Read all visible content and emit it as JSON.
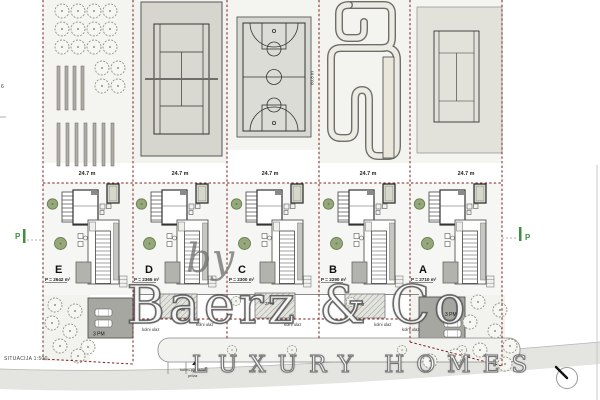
{
  "watermark": {
    "by": "by",
    "brand": "Baerz & Co",
    "tagline": "LUXURY HOMES"
  },
  "scale_label": "SITUACIJA 1:500",
  "edge_label": "6",
  "labels": {
    "kolni_ulaz": "kolni ulaz",
    "pm2": "2PM",
    "pm3": "3 PM",
    "access1": "kolno-pješački",
    "access2": "prilaz",
    "p_marker": "P",
    "court_length": "60.8 m"
  },
  "plots": [
    {
      "letter": "E",
      "area": "P = 2642 m²",
      "width_label": "24.7 m",
      "amenity": "orchard-garden"
    },
    {
      "letter": "D",
      "area": "P = 2365 m²",
      "width_label": "24.7 m",
      "amenity": "tennis-court"
    },
    {
      "letter": "C",
      "area": "P = 2300 m²",
      "width_label": "24.7 m",
      "amenity": "basketball-court"
    },
    {
      "letter": "B",
      "area": "P = 2290 m²",
      "width_label": "24.7 m",
      "amenity": "go-kart-track"
    },
    {
      "letter": "A",
      "area": "P = 2710 m²",
      "width_label": "24.7 m",
      "amenity": "tennis-court"
    }
  ],
  "colors": {
    "boundary_red": "#7b2222",
    "marker_green": "#3f8f3f",
    "court_pad": "#d6d6cf",
    "garage_gray": "#a7a7a2"
  }
}
